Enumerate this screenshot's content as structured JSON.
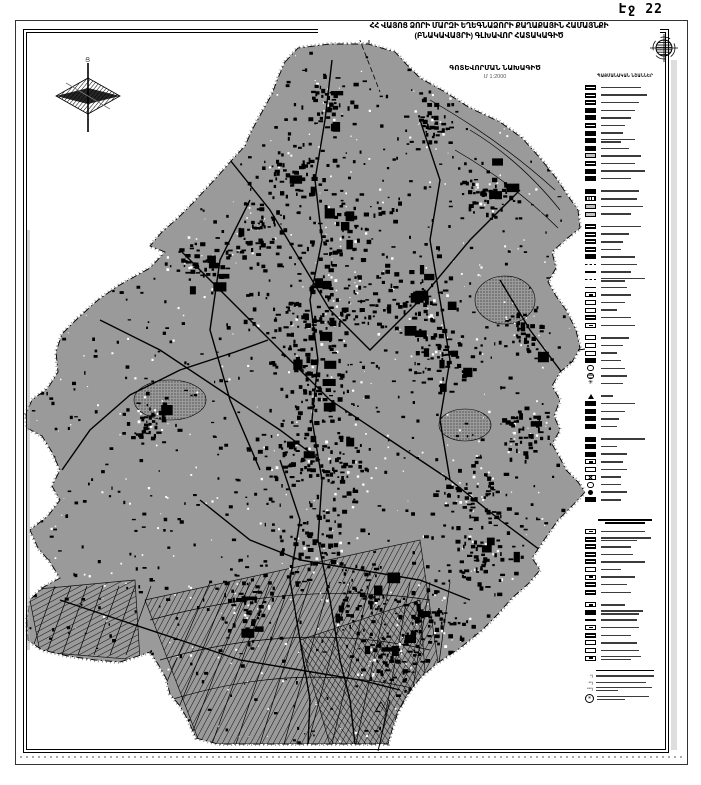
{
  "page": {
    "label": "Էջ 22"
  },
  "title": {
    "line1": "ՀՀ ՎԱՅՈՑ ՁՈՐԻ ՄԱՐԶԻ ԵՂԵԳՆԱՁՈՐԻ ՔԱՂԱՔԱՅԻՆ ՀԱՄԱՅՆՔԻ",
    "line2": "(ԲՆԱԿԱՎԱՅՐԻ) ԳԼԽԱՎՈՐ ՀԱՏԱԿԱԳԻԾ"
  },
  "subtitle": {
    "line1": "ԳՈՏԵՎՈՐՄԱՆ ՆԱԽԱԳԻԾ",
    "scale": "Մ 1:2000"
  },
  "compass": {
    "north_label": "Ց"
  },
  "colors": {
    "map_gray": "#9a9a9a",
    "ink": "#000000"
  },
  "legend": {
    "title": "ՊԱՅՄԱՆԱԿԱՆ ՆՇԱՆՆԵՐ",
    "items": [
      {
        "s": "bx-h",
        "w": 40
      },
      {
        "s": "bx-h",
        "w": 46
      },
      {
        "s": "bx-h",
        "w": 38
      },
      {
        "s": "bx-f",
        "w": 34
      },
      {
        "s": "bx-f",
        "w": 30
      },
      {
        "s": "bx-h",
        "w": 24
      },
      {
        "s": "bx-f",
        "w": 22
      },
      {
        "s": "bx-f",
        "w": 34,
        "w2": 20
      },
      {
        "s": "bx-f",
        "w": 28
      },
      {
        "s": "bx-d",
        "w": 40
      },
      {
        "s": "bx-h",
        "w": 34
      },
      {
        "s": "bx-f",
        "w": 44
      },
      {
        "s": "bx-f",
        "w": 30
      },
      {
        "s": "gap"
      },
      {
        "s": "bx-f",
        "w": 38
      },
      {
        "s": "bx-w",
        "w": 36
      },
      {
        "s": "bx-d",
        "w": 42
      },
      {
        "s": "bx-d",
        "w": 30
      },
      {
        "s": "gap"
      },
      {
        "s": "bx-h",
        "w": 40
      },
      {
        "s": "bx-h",
        "w": 28
      },
      {
        "s": "bx-h",
        "w": 22
      },
      {
        "s": "bx-h",
        "w": 20
      },
      {
        "s": "bx-f",
        "w": 34
      },
      {
        "s": "ln-d",
        "w": 36
      },
      {
        "s": "ln-t",
        "w": 30
      },
      {
        "s": "ln-d",
        "w": 44,
        "w2": 24
      },
      {
        "s": "ln-n",
        "w": 26
      },
      {
        "s": "bx-b",
        "w": 30
      },
      {
        "s": "bx-o",
        "w": 24
      },
      {
        "s": "bx-o",
        "w": 16
      },
      {
        "s": "bx-h",
        "w": 30
      },
      {
        "s": "bx-b",
        "w": 34
      },
      {
        "s": "gap"
      },
      {
        "s": "bx-o",
        "w": 28
      },
      {
        "s": "bx-o",
        "w": 22
      },
      {
        "s": "bx-o",
        "w": 16
      },
      {
        "s": "bx-f",
        "w": 20
      },
      {
        "s": "ci",
        "w": 24
      },
      {
        "s": "cg",
        "w": 26
      },
      {
        "s": "st",
        "w": 22
      },
      {
        "s": "gap"
      },
      {
        "s": "tr",
        "w": 12
      },
      {
        "s": "bx-f",
        "w": 34
      },
      {
        "s": "bx-f",
        "w": 24
      },
      {
        "s": "bx-f",
        "w": 18
      },
      {
        "s": "bx-f",
        "w": 16
      },
      {
        "s": "gap"
      },
      {
        "s": "bx-f",
        "w": 44
      },
      {
        "s": "bx-f",
        "w": 16
      },
      {
        "s": "bx-f",
        "w": 26
      },
      {
        "s": "bx-b",
        "w": 22
      },
      {
        "s": "bx-o2",
        "w": 26
      },
      {
        "s": "bx-x",
        "w": 20
      },
      {
        "s": "ci",
        "w": 20
      },
      {
        "s": "cf",
        "w": 26
      },
      {
        "s": "bx-f",
        "w": 20
      },
      {
        "s": "biggap"
      },
      {
        "s": "header",
        "w": 54,
        "w2": 40
      },
      {
        "s": "bx-b",
        "w": 44
      },
      {
        "s": "bx-h",
        "w": 50,
        "w2": 36
      },
      {
        "s": "bx-h",
        "w": 30
      },
      {
        "s": "bx-h",
        "w": 32
      },
      {
        "s": "bx-h",
        "w": 44
      },
      {
        "s": "bx-o",
        "w": 20
      },
      {
        "s": "bx-b",
        "w": 34
      },
      {
        "s": "bx-h",
        "w": 26
      },
      {
        "s": "bx-h",
        "w": 30
      },
      {
        "s": "gap"
      },
      {
        "s": "bx-b",
        "w": 24
      },
      {
        "s": "bx-f",
        "w": 42,
        "w2": 38
      },
      {
        "s": "ln-t",
        "w": 36
      },
      {
        "s": "bx-b",
        "w": 38
      },
      {
        "s": "bx-h",
        "w": 30
      },
      {
        "s": "bx-o",
        "w": 36
      },
      {
        "s": "bx-o",
        "w": 38
      },
      {
        "s": "bx-b",
        "w": 40,
        "w2": 30
      }
    ],
    "notes": {
      "header_w": 58,
      "rows": [
        {
          "m": "*)",
          "w": 58
        },
        {
          "m": "**)",
          "w": 50
        },
        {
          "m": "***)",
          "w": 56,
          "w2": 22
        },
        {
          "m": "✳",
          "w": 52,
          "w2": 28,
          "circled": true
        }
      ]
    }
  }
}
